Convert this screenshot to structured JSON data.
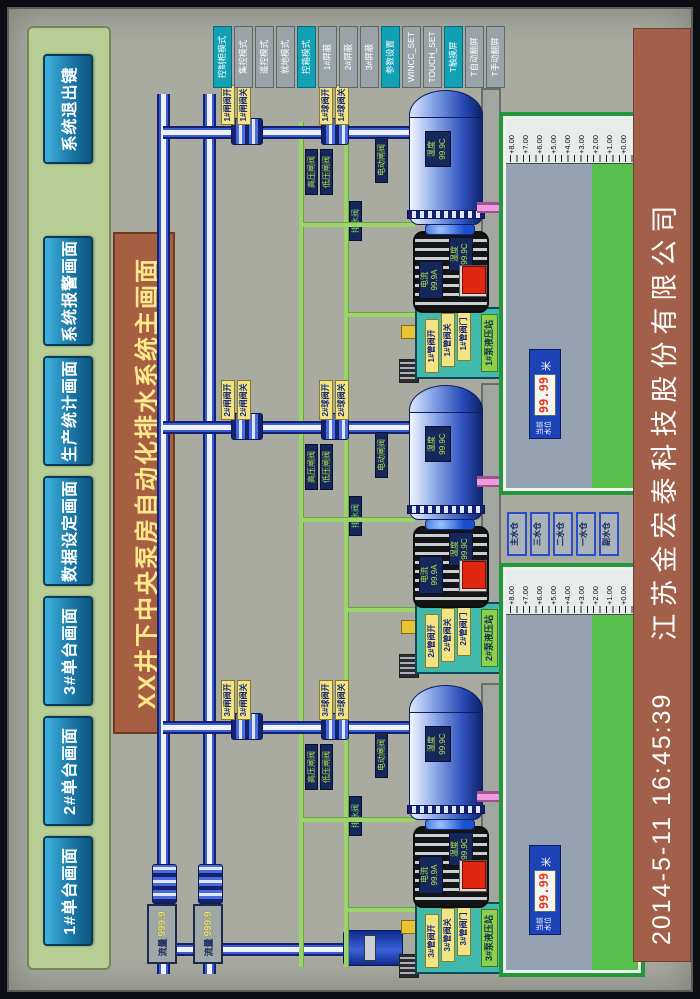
{
  "screen": {
    "title": "XX井下中央泵房自动化排水系统主画面",
    "nav": {
      "items": [
        "1#单台画面",
        "2#单台画面",
        "3#单台画面",
        "数据设定画面",
        "生产统计画面",
        "系统报警画面",
        "系统退出键"
      ]
    },
    "mode_buttons": [
      {
        "label": "控制柜模式",
        "accent": true
      },
      {
        "label": "集控模式",
        "accent": false
      },
      {
        "label": "遥控模式",
        "accent": false
      },
      {
        "label": "就地模式",
        "accent": false
      },
      {
        "label": "控箱模式",
        "accent": true
      },
      {
        "label": "1#屏蔽",
        "accent": false
      },
      {
        "label": "2#屏蔽",
        "accent": false
      },
      {
        "label": "3#屏蔽",
        "accent": false
      },
      {
        "label": "参数设置",
        "accent": true
      },
      {
        "label": "WINCC_SET",
        "accent": false
      },
      {
        "label": "TOUCH_SET",
        "accent": false
      },
      {
        "label": "T触摸屏",
        "accent": true
      },
      {
        "label": "T自动翻屏",
        "accent": false
      },
      {
        "label": "T手动翻屏",
        "accent": false
      }
    ],
    "status_bar": {
      "datetime": "2014-5-11  16:45:39",
      "company": "江苏金宏泰科技股份有限公司"
    },
    "flow_meters": [
      {
        "label": "流量",
        "value": "999.9"
      },
      {
        "label": "流量",
        "value": "999.9"
      }
    ],
    "units": [
      {
        "id": "3#",
        "valve_tags_top": [
          "3#闸阀开",
          "3#闸阀关"
        ],
        "valve_tags_mid": [
          "3#球阀开",
          "3#球阀关"
        ],
        "pipe_labels": {
          "high": "高压闸阀",
          "low": "低压闸阀",
          "electric": "电动闸阀",
          "drain": "排水阀"
        },
        "pump": {
          "temp_label": "温度",
          "temp_value": "99.9C"
        },
        "motor": {
          "current_label": "电流",
          "current_value": "99.9A",
          "temp_label": "温度",
          "temp_value": "99.9C"
        },
        "panel": {
          "title": "3#泵液压站",
          "tags": [
            "3#管阀开",
            "3#管阀关",
            "3#管阀门"
          ]
        }
      },
      {
        "id": "2#",
        "valve_tags_top": [
          "2#闸阀开",
          "2#闸阀关"
        ],
        "valve_tags_mid": [
          "2#球阀开",
          "2#球阀关"
        ],
        "pipe_labels": {
          "high": "高压闸阀",
          "low": "低压闸阀",
          "electric": "电动闸阀",
          "drain": "排水阀"
        },
        "pump": {
          "temp_label": "温度",
          "temp_value": "99.9C"
        },
        "motor": {
          "current_label": "电流",
          "current_value": "99.9A",
          "temp_label": "温度",
          "temp_value": "99.9C"
        },
        "panel": {
          "title": "2#泵液压站",
          "tags": [
            "2#管阀开",
            "2#管阀关",
            "2#管阀门"
          ]
        }
      },
      {
        "id": "1#",
        "valve_tags_top": [
          "1#闸阀开",
          "1#闸阀关"
        ],
        "valve_tags_mid": [
          "1#球阀开",
          "1#球阀关"
        ],
        "pipe_labels": {
          "high": "高压闸阀",
          "low": "低压闸阀",
          "electric": "电动闸阀",
          "drain": "排水阀"
        },
        "pump": {
          "temp_label": "温度",
          "temp_value": "99.9C"
        },
        "motor": {
          "current_label": "电流",
          "current_value": "99.9A",
          "temp_label": "温度",
          "temp_value": "99.9C"
        },
        "panel": {
          "title": "1#泵液压站",
          "tags": [
            "1#管阀开",
            "1#管阀关",
            "1#管阀门"
          ]
        }
      }
    ],
    "sumps": {
      "gauge_labels": [
        "+8.00",
        "+7.00",
        "+6.00",
        "+5.00",
        "+4.00",
        "+3.00",
        "+2.00",
        "+1.00",
        "+0.00"
      ],
      "buttons": [
        "主水仓",
        "三水仓",
        "二水仓",
        "一水仓",
        "副水仓"
      ],
      "displays": [
        {
          "label": "当前水位",
          "value": "99.99",
          "unit": "米"
        },
        {
          "label": "当前水位",
          "value": "99.99",
          "unit": "米"
        }
      ]
    },
    "colors": {
      "accent_teal": "#12a0b4",
      "panel_teal": "#41b9ac",
      "alarm_red": "#e02810",
      "pipe_green": "#9cd46c",
      "water_green": "#58c04c",
      "banner_brown": "#a65f41"
    }
  }
}
